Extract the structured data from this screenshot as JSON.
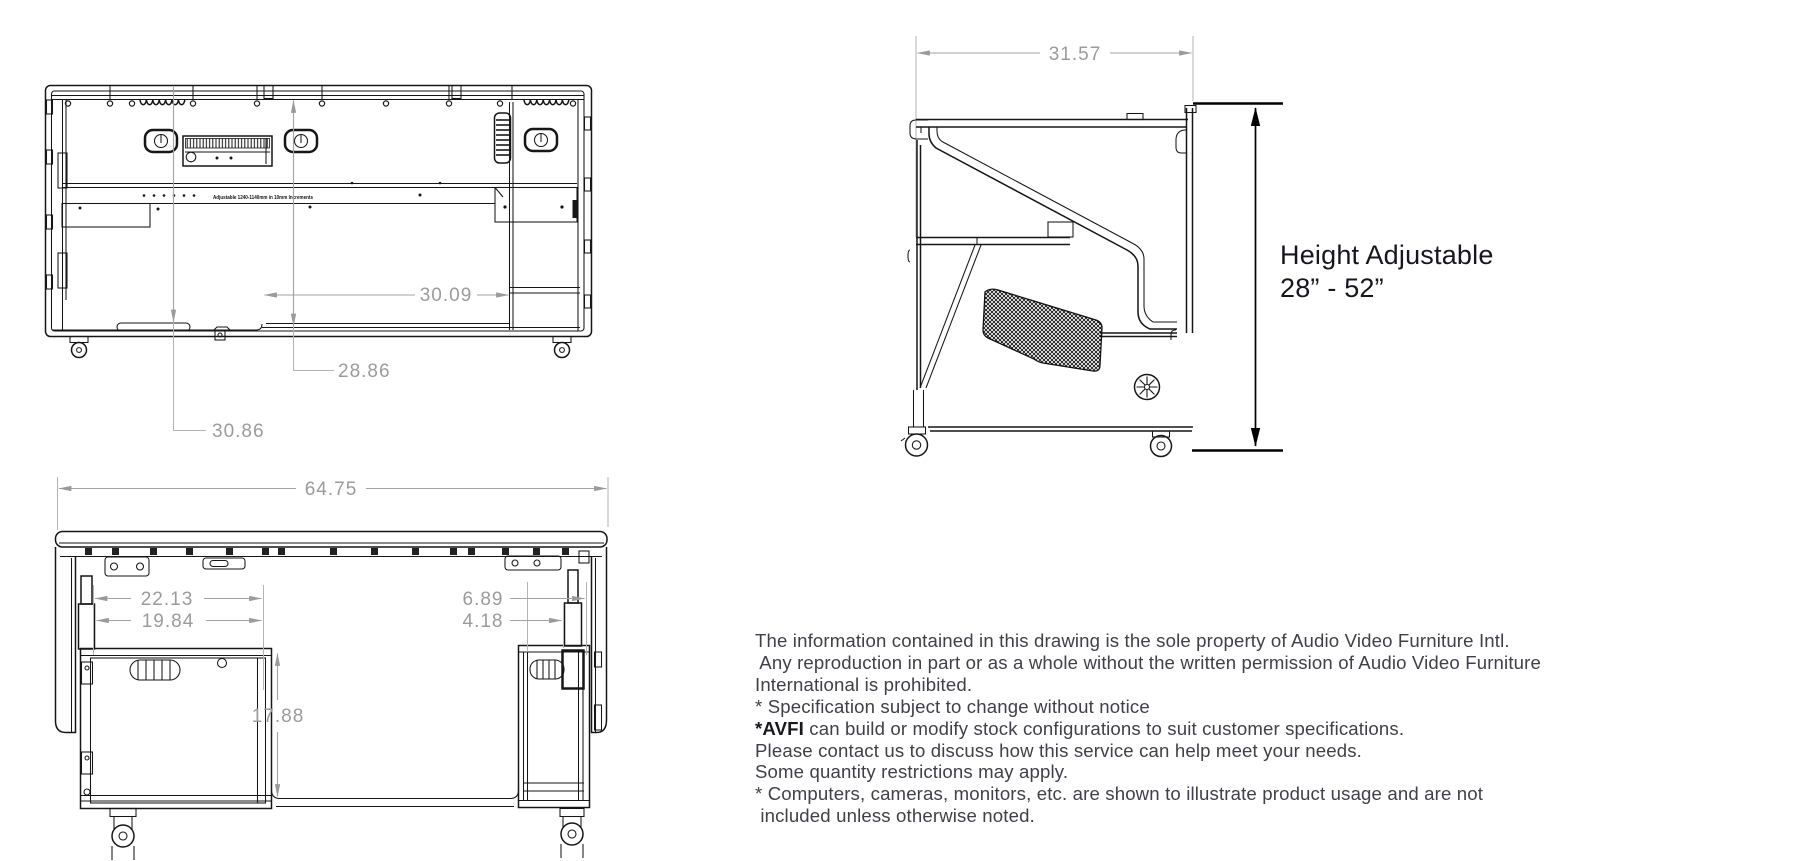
{
  "title": "Height adjustable AV desk technical drawing",
  "views": {
    "rear": {
      "dim_width_inner": "30.09",
      "dim_height_upper": "28.86",
      "dim_height_lower": "30.86",
      "rail_note": "Adjustable 1240-1140mm in 10mm Increments"
    },
    "side": {
      "dim_depth": "31.57",
      "height_note_line1": "Height Adjustable",
      "height_note_line2": "28” - 52”"
    },
    "front": {
      "dim_overall_width": "64.75",
      "dim_left_outer": "22.13",
      "dim_left_inner": "19.84",
      "dim_right_outer": "6.89",
      "dim_right_inner": "4.18",
      "dim_opening_height": "17.88"
    }
  },
  "disclaimer": {
    "line1": "The information contained in this drawing is the sole property of Audio Video Furniture Intl.",
    "line2": " Any reproduction in part or as a whole without the written permission of Audio Video Furniture",
    "line3": "International is prohibited.",
    "line4": "* Specification subject to change without notice",
    "line5_bold": "*AVFI",
    "line5_rest": " can build or modify stock configurations to suit customer specifications.",
    "line6": "Please contact us to discuss how this service can help meet your needs.",
    "line7": "Some quantity restrictions may apply.",
    "line8": "* Computers, cameras, monitors, etc. are shown to illustrate product usage and are not",
    "line9": " included unless otherwise noted."
  },
  "colors": {
    "line": "#161616",
    "dimension": "#9b9b9b",
    "text": "#40404a",
    "background": "#ffffff"
  }
}
